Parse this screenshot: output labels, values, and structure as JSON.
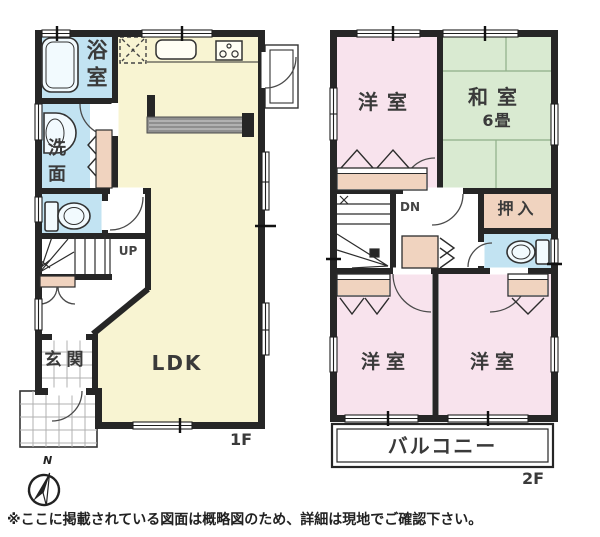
{
  "floor1": {
    "floor_label": "1F",
    "rooms": {
      "bath": "浴室",
      "washroom": "洗面",
      "ldk": "LDK",
      "entrance": "玄関"
    },
    "stairs_label": "UP"
  },
  "floor2": {
    "floor_label": "2F",
    "rooms": {
      "western_nw": "洋室",
      "japanese": "和室",
      "japanese_size": "6畳",
      "closet": "押入",
      "western_sw": "洋室",
      "western_se": "洋室"
    },
    "balcony_label": "バルコニー",
    "stairs_label": "DN"
  },
  "compass": {
    "north_label": "N"
  },
  "footnote": "※ここに掲載されている図面は概略図のため、詳細は現地でご確認下さい。",
  "colors": {
    "wall": "#262626",
    "ldk": "#f8f4d2",
    "wet_area": "#c2e3f2",
    "western_room": "#f8e3ed",
    "tatami": "#d9ead1",
    "closet": "#f0d3bf"
  }
}
